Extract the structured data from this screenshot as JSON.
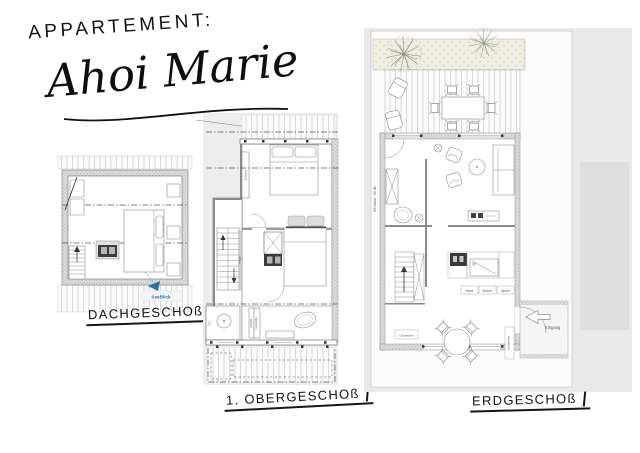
{
  "colors": {
    "accent_blue": "#2e6da4",
    "sheet_gray": "#ededed",
    "panel_gray": "#e9e9e9",
    "ink": "#141414"
  },
  "header": {
    "label": "APPARTEMENT:",
    "name": "Ahoi Marie"
  },
  "plans": {
    "dach": {
      "caption": "DACHGESCHOß",
      "seeblick_label": "SeeBlick"
    },
    "og": {
      "caption": "1. OBERGESCHOß",
      "labels": {
        "schrank_top": "Schrank",
        "regal": "Regal",
        "du": "DU",
        "schrank_bottom": "Schrank",
        "garderobe": "Garderobe"
      }
    },
    "eg": {
      "caption": "ERDGESCHOß",
      "labels": {
        "eingang": "Eingang",
        "garderobe_hall": "Garderobe",
        "garderobe_entry": "Garderobe",
        "herd": "Herd",
        "spuelm": "Spülm.",
        "spuele": "Spüle",
        "bs_wand": "BS Wand ~ 50 dB"
      }
    }
  }
}
